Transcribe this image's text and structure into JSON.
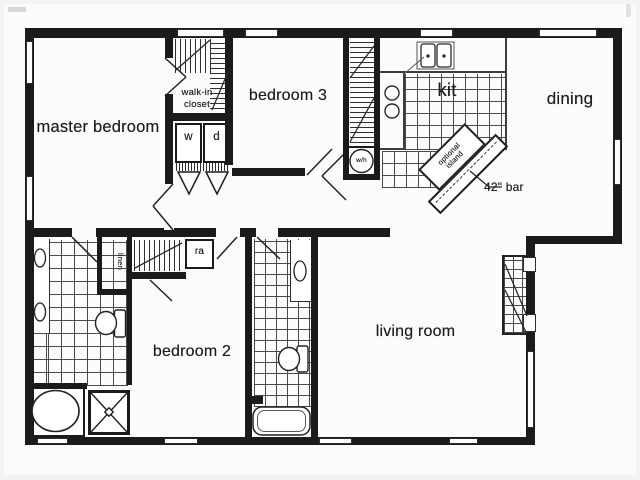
{
  "colors": {
    "wall": "#1b1b1b",
    "line": "#3e3e3e",
    "text": "#1c1c1c",
    "paper": "#fcfcfa",
    "tile_line": "#4a4a4a"
  },
  "rooms": {
    "master_bedroom": {
      "label": "master bedroom"
    },
    "walk_in_closet": {
      "line1": "walk-in",
      "line2": "closet"
    },
    "bedroom_3": {
      "label": "bedroom 3"
    },
    "kitchen": {
      "label": "kit"
    },
    "dining": {
      "label": "dining"
    },
    "bedroom_2": {
      "label": "bedroom 2"
    },
    "living_room": {
      "label": "living room"
    }
  },
  "fixtures": {
    "washer": {
      "label": "w"
    },
    "dryer": {
      "label": "d"
    },
    "water_heater": {
      "label": "w/h"
    },
    "linen_closet": {
      "label": "linen"
    },
    "return_air": {
      "label": "ra"
    },
    "optional_island": {
      "line1": "optional",
      "line2": "island"
    },
    "bar": {
      "label": "42\" bar"
    }
  }
}
